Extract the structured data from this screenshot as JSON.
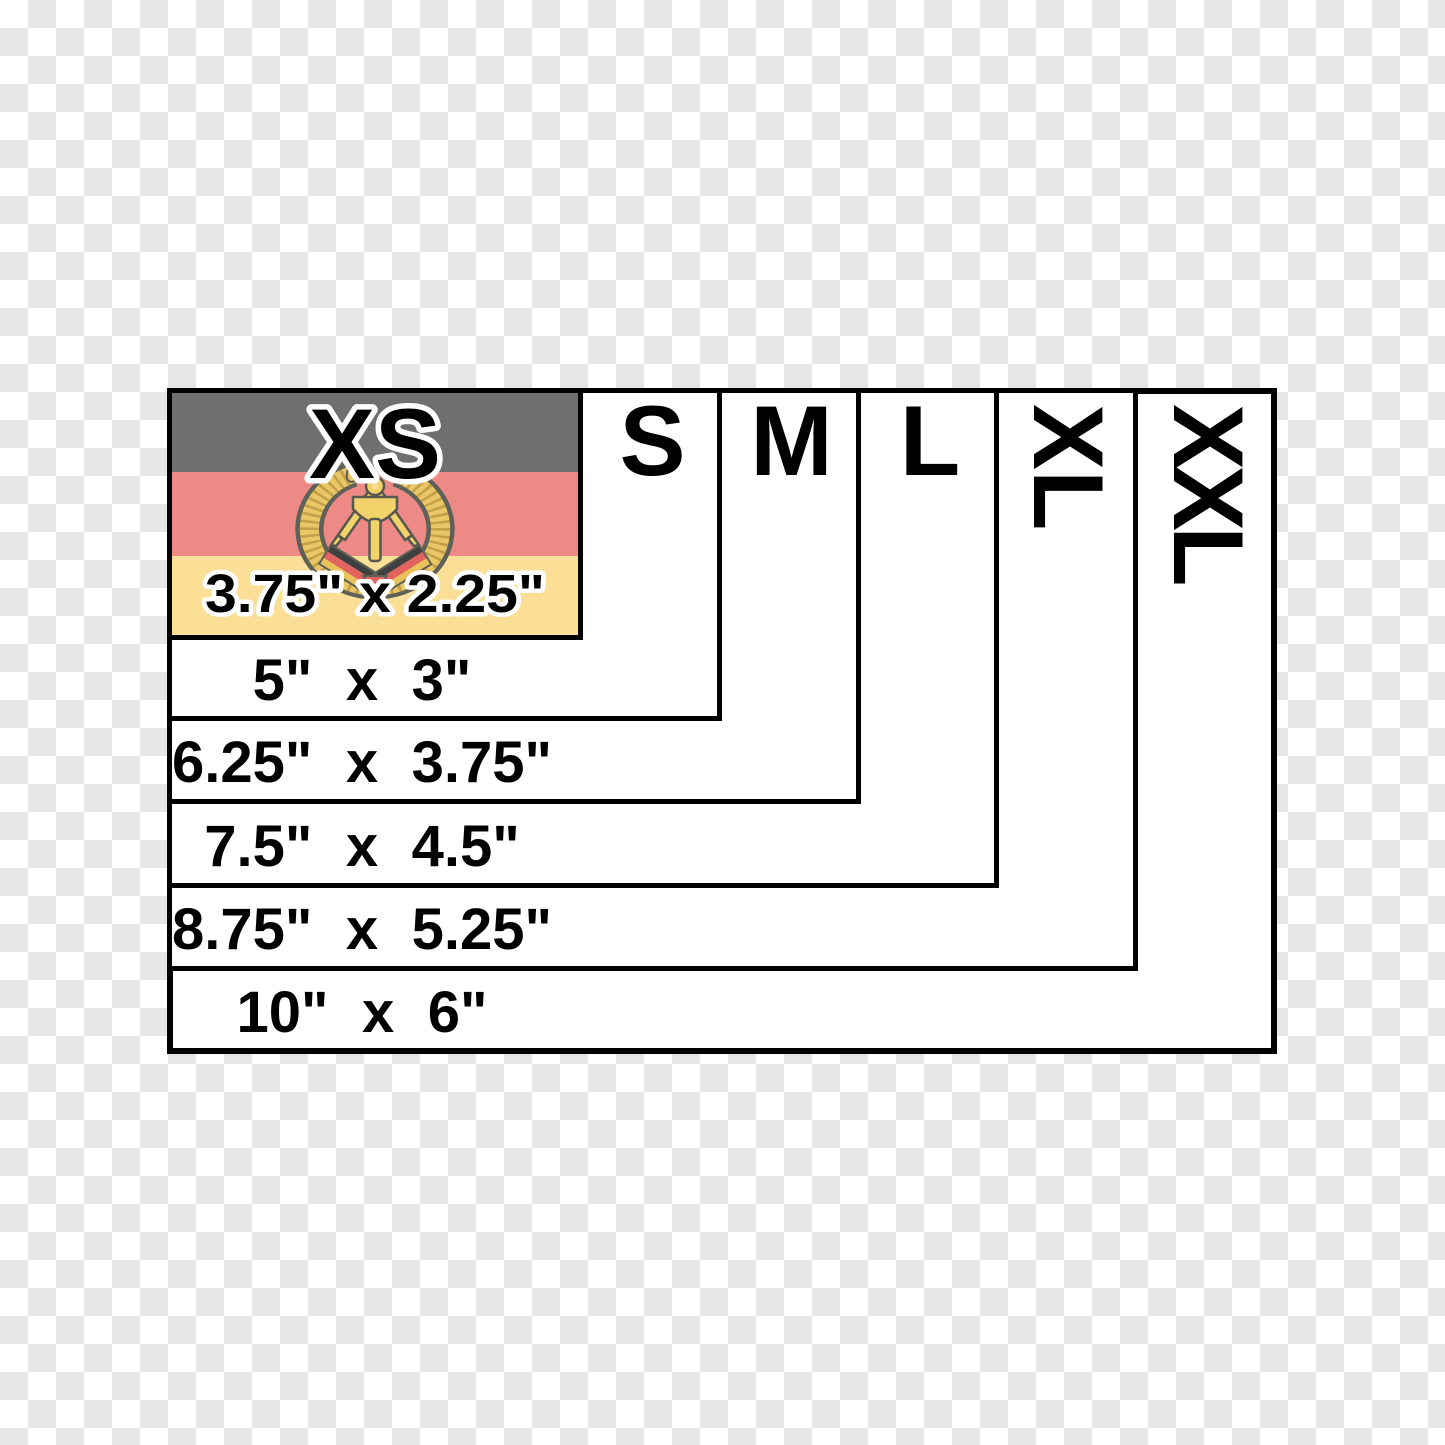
{
  "sizes": [
    {
      "label": "XS",
      "dim": "3.75\" x 2.25\""
    },
    {
      "label": "S",
      "dim": "5\" x 3\""
    },
    {
      "label": "M",
      "dim": "6.25\" x 3.75\""
    },
    {
      "label": "L",
      "dim": "7.5\" x 4.5\""
    },
    {
      "label": "XL",
      "dim": "8.75\" x 5.25\""
    },
    {
      "label": "XXL",
      "dim": "10\" x 6\""
    }
  ],
  "flag": {
    "country": "East Germany (DDR)",
    "emblem": "hammer-compass-wreath",
    "stripe_colors": [
      "#6f6f6f",
      "#ee8a85",
      "#fbdf97"
    ],
    "emblem_gold": "#e9c766",
    "emblem_outline": "#5f6057"
  },
  "background": {
    "checker_light": "#ffffff",
    "checker_dark": "#e6e6e6"
  },
  "border_color": "#000000"
}
